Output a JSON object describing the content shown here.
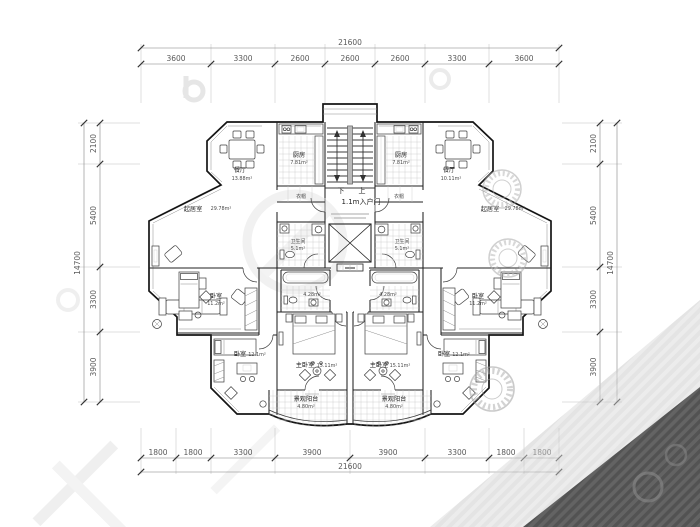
{
  "colors": {
    "background": "#ffffff",
    "wall_line": "#151515",
    "dimension_text": "#5a5a5a",
    "tile_line": "#c7c7c7",
    "watermark_light": "#e4e4e4",
    "watermark_dark": "#565656"
  },
  "dims": {
    "top": {
      "total": "21600",
      "segments": [
        "3600",
        "3300",
        "2600",
        "2600",
        "2600",
        "3300",
        "3600"
      ]
    },
    "bottom": {
      "total": "21600",
      "segments": [
        "1800",
        "1800",
        "3300",
        "3900",
        "3900",
        "3300",
        "1800",
        "1800"
      ]
    },
    "left": {
      "total": "14700",
      "segments": [
        "2100",
        "5400",
        "3300",
        "3900"
      ]
    },
    "right": {
      "total": "14700",
      "segments": [
        "2100",
        "5400",
        "3300",
        "3900"
      ]
    }
  },
  "core": {
    "down_label": "下",
    "up_label": "上",
    "entry_label": "1.1m入户门"
  },
  "left_unit": {
    "dining_name": "餐厅",
    "dining_area": "13.88m²",
    "kitchen_name": "厨房",
    "kitchen_area": "7.81m²",
    "cloak": "衣帽",
    "living_name": "起居室",
    "living_area": "29.78m²",
    "bath_name": "卫生间",
    "bath_area": "5.1m²",
    "bath2_area": "4.28m²",
    "bed_mid_name": "卧室",
    "bed_mid_area": "11.2m²",
    "bed_low_name": "卧室",
    "bed_low_area": "12.1m²",
    "master_name": "主卧室",
    "master_area": "15.11m²",
    "balcony_name": "景观阳台",
    "balcony_area": "4.80m²"
  },
  "right_unit": {
    "dining_name": "餐厅",
    "dining_area": "10.11m²",
    "kitchen_name": "厨房",
    "kitchen_area": "7.81m²",
    "cloak": "衣帽",
    "living_name": "起居室",
    "living_area": "29.78m²",
    "bath_name": "卫生间",
    "bath_area": "5.1m²",
    "bath2_area": "4.28m²",
    "bed_mid_name": "卧室",
    "bed_mid_area": "11.2m²",
    "bed_low_name": "卧室",
    "bed_low_area": "12.1m²",
    "master_name": "主卧室",
    "master_area": "15.11m²",
    "balcony_name": "景观阳台",
    "balcony_area": "4.80m²"
  }
}
